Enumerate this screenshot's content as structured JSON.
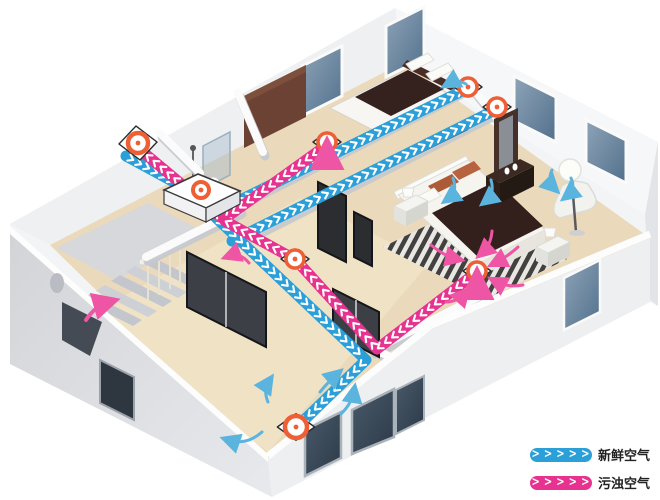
{
  "title": "whole-house fresh air ventilation system floorplan",
  "legend": {
    "items": [
      {
        "key": "fresh",
        "label": "新鲜空气",
        "color": "#2ba0d8"
      },
      {
        "key": "stale",
        "label": "污浊空气",
        "color": "#e7338f"
      }
    ],
    "chevrons": ">>>>>"
  },
  "colors": {
    "fresh": "#2ba0d8",
    "stale": "#e7338f",
    "fresh_arrow": "#5bb4de",
    "stale_arrow": "#ee55a4",
    "vent_ring": "#ee5f36",
    "floor": "#ead9ba",
    "wall": "#f1f2f4"
  },
  "diagram": {
    "flows": [
      {
        "name": "fresh-intake-duct",
        "type": "fresh",
        "points": [
          [
            126,
            156
          ],
          [
            174,
            182
          ]
        ]
      },
      {
        "name": "fresh-duct-bedroom1",
        "type": "fresh",
        "points": [
          [
            220,
            210
          ],
          [
            468,
            88
          ]
        ]
      },
      {
        "name": "fresh-duct-master-bedroom",
        "type": "fresh",
        "points": [
          [
            232,
            241
          ],
          [
            497,
            109
          ]
        ]
      },
      {
        "name": "fresh-duct-living-room",
        "type": "fresh",
        "points": [
          [
            210,
            212
          ],
          [
            366,
            360
          ],
          [
            297,
            427
          ]
        ]
      },
      {
        "name": "stale-exhaust-duct-outdoor",
        "type": "stale",
        "points": [
          [
            222,
            218
          ],
          [
            137,
            147
          ]
        ]
      },
      {
        "name": "stale-duct-bedroom1",
        "type": "stale",
        "points": [
          [
            327,
            145
          ],
          [
            224,
            219
          ]
        ]
      },
      {
        "name": "stale-duct-master-hallway",
        "type": "stale",
        "points": [
          [
            477,
            272
          ],
          [
            377,
            349
          ],
          [
            296,
            260
          ],
          [
            225,
            221
          ]
        ]
      }
    ],
    "vents": [
      {
        "name": "outdoor-wall-vent",
        "x": 138,
        "y": 143,
        "r": 7,
        "style": "panel"
      },
      {
        "name": "bedroom1-supply-vent",
        "x": 468,
        "y": 87,
        "r": 6,
        "style": "floor"
      },
      {
        "name": "master-supply-vent",
        "x": 497,
        "y": 107,
        "r": 6,
        "style": "floor"
      },
      {
        "name": "bedroom1-exhaust-vent",
        "x": 327,
        "y": 142,
        "r": 6,
        "style": "floor"
      },
      {
        "name": "hallway-exhaust-vent",
        "x": 295,
        "y": 259,
        "r": 6,
        "style": "floor"
      },
      {
        "name": "master-exhaust-vent",
        "x": 477,
        "y": 271,
        "r": 6,
        "style": "floor"
      },
      {
        "name": "living-supply-diffuser",
        "x": 296,
        "y": 427,
        "r": 8,
        "style": "floor"
      }
    ],
    "arrows": [
      {
        "name": "living-air-arrow",
        "type": "fresh",
        "d": "M262,432 Q246,446 228,440"
      },
      {
        "name": "living-air-arrow",
        "type": "fresh",
        "d": "M268,402 Q263,390 269,381"
      },
      {
        "name": "living-air-arrow",
        "type": "fresh",
        "d": "M320,392 Q329,381 337,374"
      },
      {
        "name": "living-air-arrow",
        "type": "fresh",
        "d": "M341,414 Q352,403 354,391"
      },
      {
        "name": "master-air-arrow",
        "type": "fresh",
        "d": "M453,178 Q458,192 448,199"
      },
      {
        "name": "master-air-arrow",
        "type": "fresh",
        "d": "M491,180 Q495,194 486,201"
      },
      {
        "name": "master-air-arrow",
        "type": "fresh",
        "d": "M552,170 Q547,181 554,188"
      },
      {
        "name": "master-air-arrow",
        "type": "fresh",
        "d": "M571,178 Q576,189 567,196"
      },
      {
        "name": "bedroom1-air-arrow",
        "type": "fresh",
        "d": "M466,84 Q457,79 448,84"
      },
      {
        "name": "stairs-air-arrow",
        "type": "stale",
        "d": "M86,320 Q95,306 109,302",
        "w": 4
      },
      {
        "name": "hallway-air-arrow",
        "type": "stale",
        "d": "M249,263 Q240,252 229,256"
      },
      {
        "name": "master-exhaust-arrow",
        "type": "stale",
        "d": "M431,245 Q444,256 457,259"
      },
      {
        "name": "master-exhaust-arrow",
        "type": "stale",
        "d": "M492,231 Q491,245 482,253"
      },
      {
        "name": "master-exhaust-arrow",
        "type": "stale",
        "d": "M518,247 Q507,257 495,263"
      },
      {
        "name": "master-exhaust-arrow",
        "type": "stale",
        "d": "M523,285 Q508,288 495,281"
      },
      {
        "name": "master-exhaust-arrow",
        "type": "stale",
        "d": "M446,302 Q457,302 465,293"
      },
      {
        "name": "bedroom1-exhaust-arrow",
        "type": "stale",
        "d": "M327,164 L327,150",
        "w": 5
      },
      {
        "name": "master-vent-arrow",
        "type": "stale",
        "d": "M477,294 L477,280",
        "w": 5
      }
    ]
  }
}
